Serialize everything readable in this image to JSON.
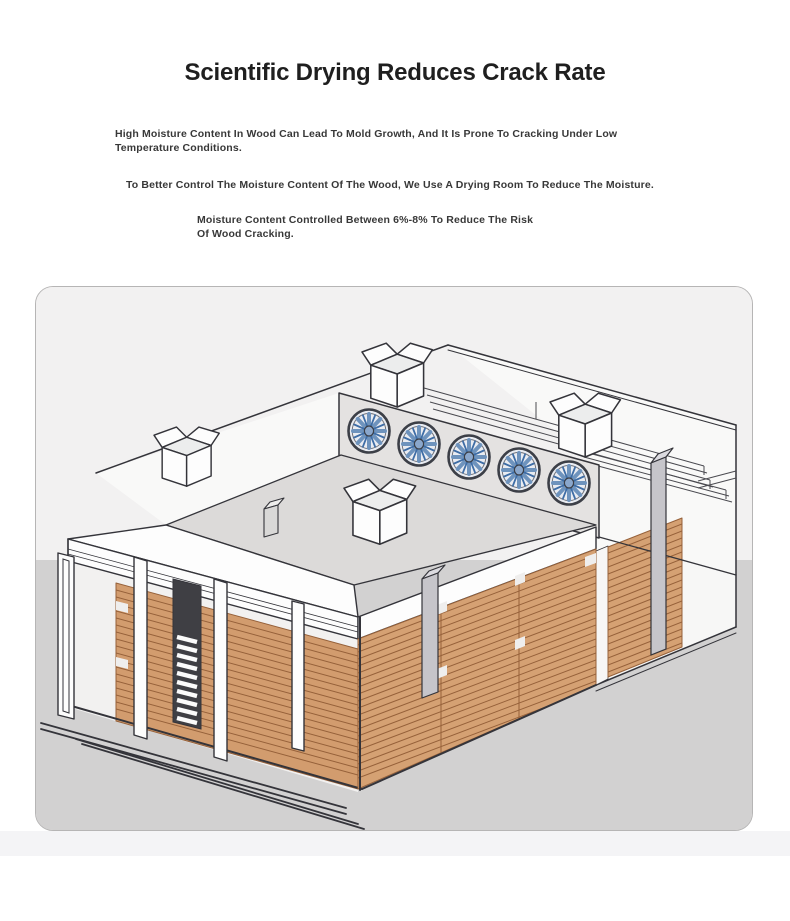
{
  "page": {
    "title": "Scientific Drying Reduces Crack Rate",
    "paragraphs": [
      {
        "lines": [
          "High Moisture Content In Wood Can Lead To Mold Growth, And It Is Prone To Cracking Under Low",
          "Temperature Conditions."
        ]
      },
      {
        "lines": [
          "To Better Control The Moisture Content Of The Wood, We Use A Drying Room To Reduce The Moisture."
        ]
      },
      {
        "lines": [
          "Moisture Content Controlled Between 6%-8% To Reduce The Risk",
          "Of Wood Cracking."
        ]
      }
    ]
  },
  "illustration": {
    "description": "Isometric cutaway diagram of a wood drying room with roof exhaust fans, roof vent boxes, ceiling rails and stacked lumber",
    "exhaust_fan_count": 5,
    "roof_vent_count": 4
  },
  "colors": {
    "page_bg": "#ffffff",
    "strip": "#f4f4f6",
    "title_color": "#1f1f1f",
    "body_color": "#383838",
    "card_bg_top": "#f2f1f1",
    "card_bg_ground": "#d2d1d1",
    "card_border": "#b6b5b5",
    "line": "#34343a",
    "wall": "#fdfdfd",
    "wall_shade": "#f2f1f0",
    "roof": "#dcdad9",
    "panel": "#e4e2e1",
    "wood": "#d5a173",
    "wood_inner": "#d29c6e",
    "wood_line": "#96613a",
    "post": "#c6c5ca",
    "rail": "#4a4a50",
    "fan_ring": "#3c3f47",
    "fan_face": "#e9ecf2",
    "fan_blade_light": "#6e93bd",
    "fan_blade_dark": "#3e6da6",
    "fan_hub": "#8aa7cc"
  }
}
